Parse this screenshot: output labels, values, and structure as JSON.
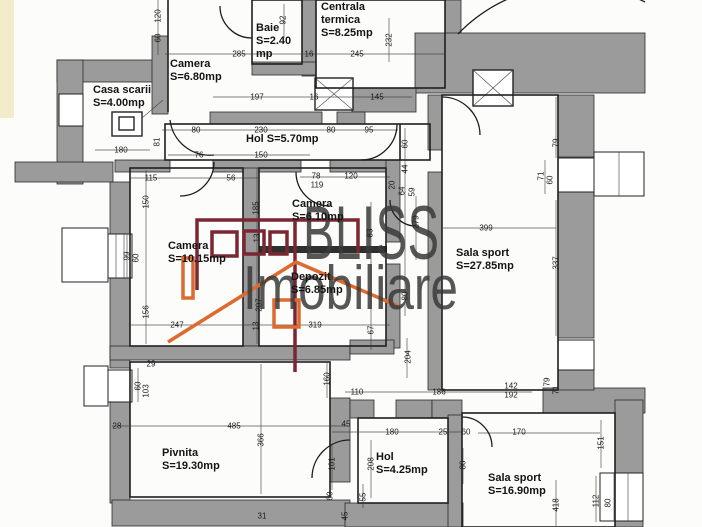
{
  "document": {
    "type_label": "floor plan scan"
  },
  "watermark": {
    "line1": "BLISS",
    "line2": "Imobiliare"
  },
  "colors": {
    "wall_gray": "#9b9b9b",
    "line_black": "#1c1c1c",
    "logo_maroon": "#7a2733",
    "logo_orange": "#dd6a2f",
    "watermark_gray": "#3a3a3a",
    "paper": "#fcfcfa"
  },
  "rooms": [
    {
      "name": "Casa scarii",
      "area": "S=4.00mp",
      "x": 93,
      "y": 84,
      "w": 78
    },
    {
      "name": "Camera",
      "area": "S=6.80mp",
      "x": 170,
      "y": 58,
      "w": 90
    },
    {
      "name": "Baie",
      "area": "S=2.40 mp",
      "x": 256,
      "y": 22,
      "w": 52
    },
    {
      "name": "Centrala termica",
      "area": "S=8.25mp",
      "x": 321,
      "y": 1,
      "w": 78
    },
    {
      "name": "Hol",
      "area": "S=5.70mp",
      "x": 246,
      "y": 133,
      "w": 130
    },
    {
      "name": "Camera",
      "area": "S=6.10mp",
      "x": 292,
      "y": 198,
      "w": 70
    },
    {
      "name": "Camera",
      "area": "S=10.15mp",
      "x": 168,
      "y": 240,
      "w": 80
    },
    {
      "name": "Depozit",
      "area": "S=6.85mp",
      "x": 291,
      "y": 271,
      "w": 80
    },
    {
      "name": "Sala sport",
      "area": "S=27.85mp",
      "x": 456,
      "y": 247,
      "w": 84
    },
    {
      "name": "Pivnita",
      "area": "S=19.30mp",
      "x": 162,
      "y": 447,
      "w": 90
    },
    {
      "name": "Hol",
      "area": "S=4.25mp",
      "x": 376,
      "y": 451,
      "w": 62
    },
    {
      "name": "Sala sport",
      "area": "S=16.90mp",
      "x": 488,
      "y": 472,
      "w": 84
    }
  ],
  "dimensions": [
    {
      "t": "285",
      "x": 239,
      "y": 54
    },
    {
      "t": "16",
      "x": 309,
      "y": 54
    },
    {
      "t": "245",
      "x": 357,
      "y": 54
    },
    {
      "t": "197",
      "x": 257,
      "y": 97
    },
    {
      "t": "16",
      "x": 314,
      "y": 97
    },
    {
      "t": "145",
      "x": 377,
      "y": 97
    },
    {
      "t": "180",
      "x": 121,
      "y": 150
    },
    {
      "t": "80",
      "x": 196,
      "y": 130
    },
    {
      "t": "230",
      "x": 261,
      "y": 130
    },
    {
      "t": "80",
      "x": 331,
      "y": 130
    },
    {
      "t": "95",
      "x": 369,
      "y": 130
    },
    {
      "t": "76",
      "x": 199,
      "y": 155
    },
    {
      "t": "150",
      "x": 261,
      "y": 155
    },
    {
      "t": "115",
      "x": 151,
      "y": 178
    },
    {
      "t": "56",
      "x": 231,
      "y": 178
    },
    {
      "t": "78",
      "x": 316,
      "y": 176
    },
    {
      "t": "119",
      "x": 317,
      "y": 185
    },
    {
      "t": "120",
      "x": 351,
      "y": 176
    },
    {
      "t": "247",
      "x": 177,
      "y": 325
    },
    {
      "t": "319",
      "x": 315,
      "y": 325
    },
    {
      "t": "399",
      "x": 486,
      "y": 228
    },
    {
      "t": "110",
      "x": 357,
      "y": 392
    },
    {
      "t": "186",
      "x": 439,
      "y": 392
    },
    {
      "t": "142",
      "x": 511,
      "y": 386
    },
    {
      "t": "192",
      "x": 511,
      "y": 395
    },
    {
      "t": "170",
      "x": 519,
      "y": 432
    },
    {
      "t": "45",
      "x": 346,
      "y": 424
    },
    {
      "t": "180",
      "x": 392,
      "y": 432
    },
    {
      "t": "25",
      "x": 443,
      "y": 432
    },
    {
      "t": "60",
      "x": 466,
      "y": 432
    },
    {
      "t": "485",
      "x": 234,
      "y": 426
    },
    {
      "t": "28",
      "x": 117,
      "y": 426
    },
    {
      "t": "29",
      "x": 151,
      "y": 364
    },
    {
      "t": "31",
      "x": 262,
      "y": 516
    },
    {
      "t": "120",
      "x": 158,
      "y": 16,
      "r": 1
    },
    {
      "t": "60",
      "x": 158,
      "y": 38,
      "r": 1
    },
    {
      "t": "92",
      "x": 283,
      "y": 20,
      "r": 1
    },
    {
      "t": "232",
      "x": 389,
      "y": 40,
      "r": 1
    },
    {
      "t": "81",
      "x": 157,
      "y": 142,
      "r": 1
    },
    {
      "t": "150",
      "x": 146,
      "y": 202,
      "r": 1
    },
    {
      "t": "99",
      "x": 127,
      "y": 256,
      "r": 1
    },
    {
      "t": "60",
      "x": 136,
      "y": 258,
      "r": 1
    },
    {
      "t": "156",
      "x": 146,
      "y": 312,
      "r": 1
    },
    {
      "t": "185",
      "x": 256,
      "y": 208,
      "r": 1
    },
    {
      "t": "13",
      "x": 257,
      "y": 238,
      "r": 1
    },
    {
      "t": "207",
      "x": 259,
      "y": 305,
      "r": 1
    },
    {
      "t": "13",
      "x": 256,
      "y": 326,
      "r": 1
    },
    {
      "t": "60",
      "x": 405,
      "y": 144,
      "r": 1
    },
    {
      "t": "44",
      "x": 405,
      "y": 169,
      "r": 1
    },
    {
      "t": "20",
      "x": 392,
      "y": 185,
      "r": 1
    },
    {
      "t": "64",
      "x": 402,
      "y": 191,
      "r": 1
    },
    {
      "t": "59",
      "x": 412,
      "y": 192,
      "r": 1
    },
    {
      "t": "279",
      "x": 416,
      "y": 222,
      "r": 1
    },
    {
      "t": "83",
      "x": 370,
      "y": 233,
      "r": 1
    },
    {
      "t": "80",
      "x": 405,
      "y": 296,
      "r": 1
    },
    {
      "t": "67",
      "x": 371,
      "y": 330,
      "r": 1
    },
    {
      "t": "204",
      "x": 408,
      "y": 357,
      "r": 1
    },
    {
      "t": "79",
      "x": 556,
      "y": 143,
      "r": 1
    },
    {
      "t": "71",
      "x": 541,
      "y": 176,
      "r": 1
    },
    {
      "t": "60",
      "x": 550,
      "y": 180,
      "r": 1
    },
    {
      "t": "337",
      "x": 556,
      "y": 263,
      "r": 1
    },
    {
      "t": "79",
      "x": 547,
      "y": 382,
      "r": 1
    },
    {
      "t": "71",
      "x": 556,
      "y": 390,
      "r": 1
    },
    {
      "t": "160",
      "x": 327,
      "y": 379,
      "r": 1
    },
    {
      "t": "101",
      "x": 332,
      "y": 464,
      "r": 1
    },
    {
      "t": "60",
      "x": 330,
      "y": 496,
      "r": 1
    },
    {
      "t": "208",
      "x": 371,
      "y": 464,
      "r": 1
    },
    {
      "t": "55",
      "x": 363,
      "y": 497,
      "r": 1
    },
    {
      "t": "45",
      "x": 345,
      "y": 516,
      "r": 1
    },
    {
      "t": "80",
      "x": 463,
      "y": 465,
      "r": 1
    },
    {
      "t": "151",
      "x": 601,
      "y": 443,
      "r": 1
    },
    {
      "t": "112",
      "x": 596,
      "y": 501,
      "r": 1
    },
    {
      "t": "80",
      "x": 608,
      "y": 503,
      "r": 1
    },
    {
      "t": "418",
      "x": 556,
      "y": 505,
      "r": 1
    },
    {
      "t": "60",
      "x": 138,
      "y": 386,
      "r": 1
    },
    {
      "t": "103",
      "x": 146,
      "y": 391,
      "r": 1
    },
    {
      "t": "366",
      "x": 261,
      "y": 440,
      "r": 1
    }
  ]
}
